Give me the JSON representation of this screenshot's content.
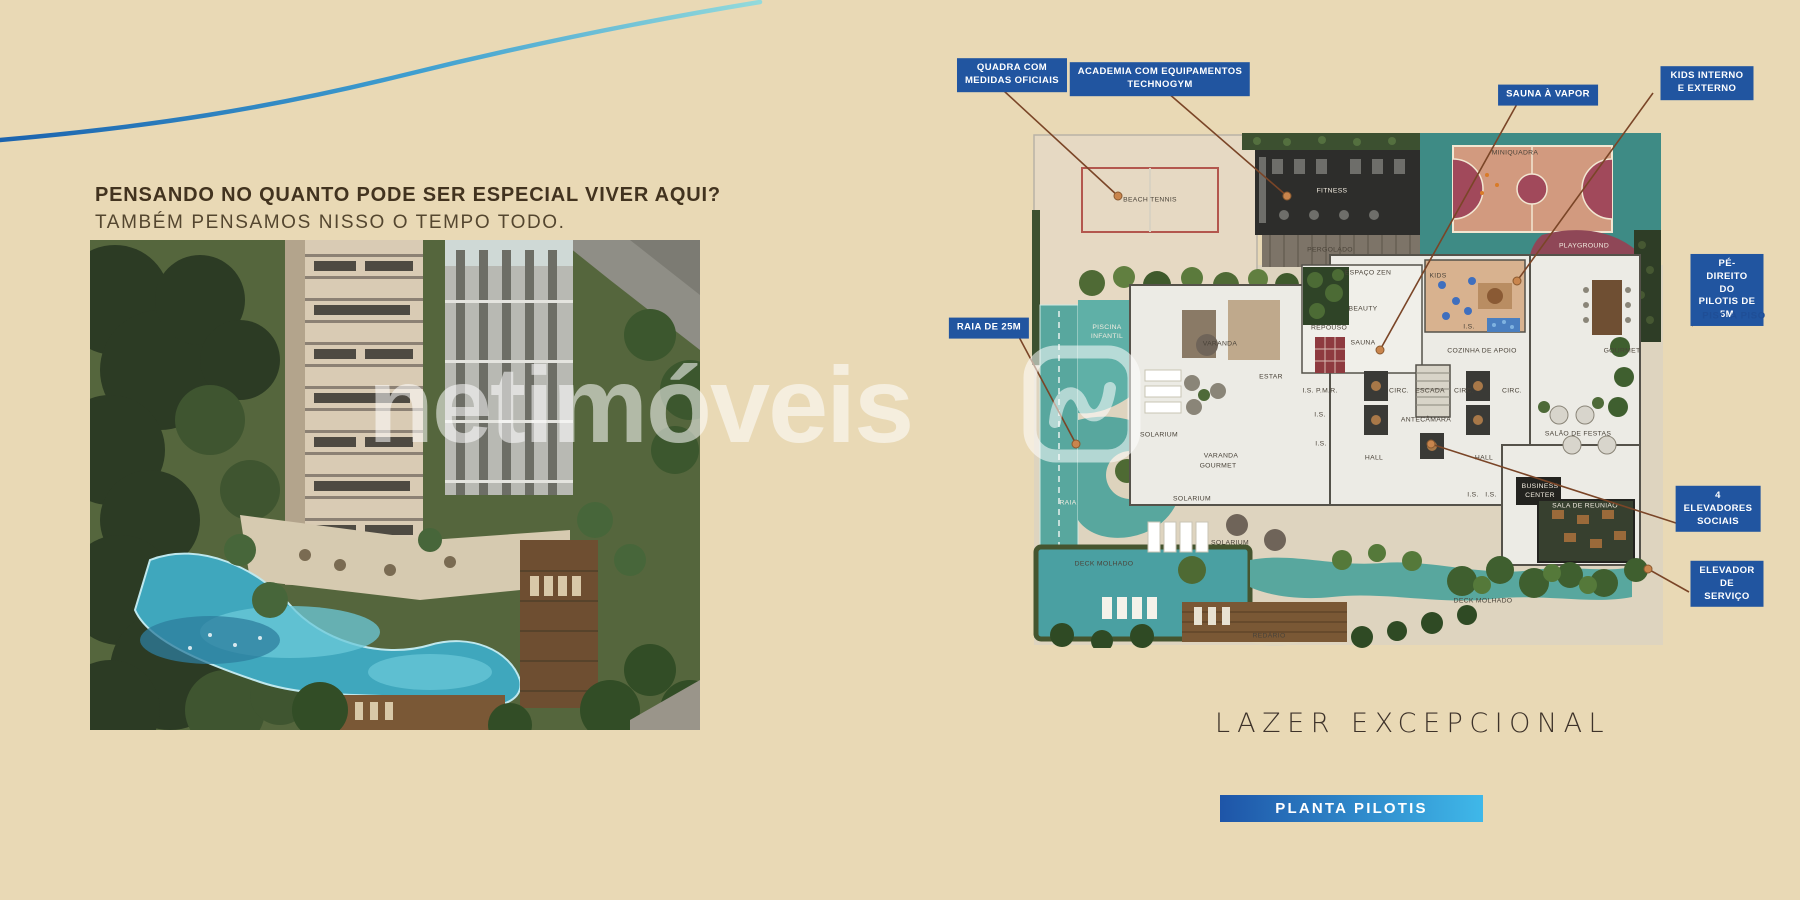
{
  "colors": {
    "background": "#e9d9b5",
    "badge_blue": "#2155a0",
    "button_gradient_left": "#1e55a8",
    "button_gradient_right": "#3fb8e9",
    "headline_brown": "#42331f",
    "leader_line_brown": "#7a4527",
    "watermark_white": "rgba(255,255,255,0.55)",
    "pool_teal": "#55a79e",
    "court_maroon": "#a1495b"
  },
  "intro": {
    "headline": "PENSANDO NO QUANTO PODE SER ESPECIAL VIVER AQUI?",
    "subheadline": "TAMBÉM PENSAMOS NISSO O TEMPO TODO."
  },
  "watermark": {
    "text": "netimóveis",
    "logo": "netimoveis-logo"
  },
  "plan": {
    "caption": "LAZER EXCEPCIONAL",
    "button_label": "PLANTA PILOTIS",
    "callouts": [
      {
        "id": "quadra-oficial",
        "label": "QUADRA COM\nMEDIDAS OFICIAIS",
        "x": 1012,
        "y": 75,
        "line": [
          1004,
          91,
          1118,
          196
        ],
        "dot": true
      },
      {
        "id": "academia-technogym",
        "label": "ACADEMIA COM EQUIPAMENTOS\nTECHNOGYM",
        "x": 1160,
        "y": 79,
        "line": [
          1168,
          93,
          1287,
          196
        ],
        "dot": true
      },
      {
        "id": "sauna-vapor",
        "label": "SAUNA À VAPOR",
        "x": 1548,
        "y": 95,
        "line": [
          1517,
          104,
          1380,
          350
        ],
        "dot": true
      },
      {
        "id": "kids-interno-externo",
        "label": "KIDS INTERNO E EXTERNO",
        "x": 1707,
        "y": 83,
        "line": [
          1653,
          93,
          1517,
          281
        ],
        "dot": true
      },
      {
        "id": "raia-25m",
        "label": "RAIA DE 25M",
        "x": 989,
        "y": 328,
        "line": [
          1019,
          337,
          1076,
          444
        ],
        "dot": true
      },
      {
        "id": "pe-direito-pilotis",
        "label": "PÉ-DIREITO DO\nPILOTIS DE 5M",
        "x": 1727,
        "y": 290,
        "line": [
          1692,
          326,
          1706,
          306
        ],
        "dot": false
      },
      {
        "id": "elevadores-sociais",
        "label": "4 ELEVADORES\nSOCIAIS",
        "x": 1718,
        "y": 509,
        "line": [
          1679,
          524,
          1431,
          444
        ],
        "dot": true
      },
      {
        "id": "elevador-servico",
        "label": "ELEVADOR\nDE SERVIÇO",
        "x": 1727,
        "y": 584,
        "line": [
          1689,
          592,
          1648,
          569
        ],
        "dot": true
      }
    ],
    "sub_callout": {
      "label": "PISO A PISO",
      "x": 1734,
      "y": 316
    },
    "room_labels": [
      {
        "t": "BEACH TENNIS",
        "x": 118,
        "y": 86
      },
      {
        "t": "FITNESS",
        "x": 300,
        "y": 77,
        "light": true
      },
      {
        "t": "PERGOLADO",
        "x": 298,
        "y": 136
      },
      {
        "t": "MINIQUADRA",
        "x": 483,
        "y": 39
      },
      {
        "t": "PLAYGROUND",
        "x": 552,
        "y": 132,
        "light": true
      },
      {
        "t": "ESPAÇO ZEN",
        "x": 336,
        "y": 159
      },
      {
        "t": "KIDS",
        "x": 406,
        "y": 162
      },
      {
        "t": "BEAUTY",
        "x": 331,
        "y": 195
      },
      {
        "t": "REPOUSO",
        "x": 297,
        "y": 214
      },
      {
        "t": "SAUNA",
        "x": 331,
        "y": 229
      },
      {
        "t": "VARANDA",
        "x": 188,
        "y": 230
      },
      {
        "t": "ESTAR",
        "x": 239,
        "y": 263
      },
      {
        "t": "I.S. P.M.R.",
        "x": 288,
        "y": 277
      },
      {
        "t": "I.S.",
        "x": 288,
        "y": 301
      },
      {
        "t": "I.S.",
        "x": 289,
        "y": 330
      },
      {
        "t": "CIRC.",
        "x": 367,
        "y": 277
      },
      {
        "t": "ESCADA",
        "x": 398,
        "y": 277
      },
      {
        "t": "CIRC.",
        "x": 432,
        "y": 277
      },
      {
        "t": "CIRC.",
        "x": 480,
        "y": 277
      },
      {
        "t": "ANTECÂMARA",
        "x": 394,
        "y": 306
      },
      {
        "t": "HALL",
        "x": 342,
        "y": 344
      },
      {
        "t": "HALL",
        "x": 452,
        "y": 344
      },
      {
        "t": "I.S.",
        "x": 437,
        "y": 213
      },
      {
        "t": "COZINHA DE APOIO",
        "x": 450,
        "y": 237
      },
      {
        "t": "GOURMET",
        "x": 590,
        "y": 237
      },
      {
        "t": "SALÃO DE FESTAS",
        "x": 546,
        "y": 320
      },
      {
        "t": "BUSINESS\nCENTER",
        "x": 508,
        "y": 377,
        "light": true
      },
      {
        "t": "SALA DE REUNIÃO",
        "x": 553,
        "y": 392,
        "light": true
      },
      {
        "t": "VARANDA",
        "x": 189,
        "y": 342
      },
      {
        "t": "SOLARIUM",
        "x": 127,
        "y": 321
      },
      {
        "t": "SOLARIUM",
        "x": 198,
        "y": 429
      },
      {
        "t": "SOLARIUM",
        "x": 160,
        "y": 385
      },
      {
        "t": "GOURMET",
        "x": 186,
        "y": 352
      },
      {
        "t": "I.S.",
        "x": 441,
        "y": 381
      },
      {
        "t": "I.S.",
        "x": 459,
        "y": 381
      },
      {
        "t": "DECK MOLHADO",
        "x": 72,
        "y": 450
      },
      {
        "t": "DECK MOLHADO",
        "x": 451,
        "y": 487
      },
      {
        "t": "REDÁRIO",
        "x": 237,
        "y": 522
      },
      {
        "t": "PISCINA\nINFANTIL",
        "x": 75,
        "y": 218,
        "light": true
      },
      {
        "t": "RAIA",
        "x": 36,
        "y": 389,
        "light": true
      }
    ]
  }
}
